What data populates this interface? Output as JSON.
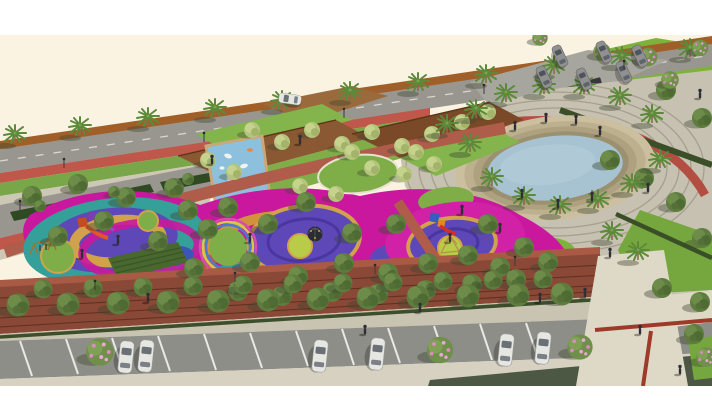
{
  "meta": {
    "kind": "3D architectural rendering",
    "subject": "Aerial bird's-eye visualization of a public park and playground master plan",
    "canvas": {
      "width": 712,
      "height": 416
    },
    "margins": {
      "top_white_band_px": 35,
      "bottom_white_band_px": 30
    }
  },
  "palette": {
    "margin": "#FFFFFF",
    "sky": "#FAF3E2",
    "road": "#98968E",
    "road_wall": "#A05F28",
    "bike_red": "#BF574A",
    "verge_green": "#79A648",
    "sidewalk": "#CDC7B6",
    "parking_lot": "#A7A69E",
    "plaza": "#C6C1B1",
    "plaza_arc": "#A79F8C",
    "walkway": "#DED8C6",
    "track_red": "#B2493C",
    "inlay_red": "#9E3A2A",
    "street": "#8E8E88",
    "curb": "#C9C3B2",
    "terrace_brick": "#8A4836",
    "terrace_walk": "#A85A44",
    "brick_path": "#B05C4A",
    "lawn": "#7FAE48",
    "lawn_bright": "#7FB23C",
    "hedge": "#2F4A22",
    "hedge_shadow": "#4C5844",
    "water": "#A7C2D1",
    "pond_step1": "#CBBF9F",
    "pond_step2": "#BCB08F",
    "pond_step3": "#ADA180",
    "pond_step4": "#9B9070",
    "deck_light": "#9A6A3C",
    "deck": "#8A5832",
    "deck_dark": "#7A4A28",
    "mural_blue": "#8CC0DC",
    "magenta": "#C9189D",
    "pink_bright": "#E455BE",
    "purple": "#5E48B8",
    "purple_deep": "#4A36A0",
    "orange_ring": "#D2A14C",
    "orange_band": "#D2923C",
    "teal": "#35A09A",
    "blue_patch": "#3D55B4",
    "lawn_circle": "#B9CC4A",
    "shrub_bed": "#49682F",
    "tree_olive": "#5D7C3E",
    "tree_light": "#B5C47C",
    "palm_green": "#5C8A3A",
    "blossom_pink": "#D98CC3",
    "car_white": "#E6E6E2",
    "car_gray": "#909090",
    "figure_dark": "#2E2E34"
  },
  "scene": {
    "areas": [
      {
        "name": "top-road",
        "description": "Palm-lined avenue running diagonally along the top edge behind an orange-brown hedge wall"
      },
      {
        "name": "parking-lot-top-right",
        "description": "Small parking lot with six gray cars, blossoming trees and two dark ramp entries"
      },
      {
        "name": "lawn-slope-top-right",
        "description": "Bright green sloped lawn panel at top right corner"
      },
      {
        "name": "terraced-decks",
        "description": "Brown timber terraced decks and ramps interleaved with lawn wedges and light-green trees"
      },
      {
        "name": "koi-mural",
        "description": "Sloped light-blue mosaic triangle with white koi-fish pattern set into the decks"
      },
      {
        "name": "pond-plaza",
        "description": "Circular pond with light blue water, concentric tan step rings, palm ring and gray plaza with arc paving lines"
      },
      {
        "name": "playground",
        "description": "Organic playground field of magenta, purple, orange, teal and blue rubber surfacing with lawn circles, slides, swings, climbing dome and rope pyramid"
      },
      {
        "name": "brick-terraces",
        "description": "Red-brick terraced edge with double staggered row of round clipped trees"
      },
      {
        "name": "street-bottom",
        "description": "Parking street with white bay lines, six white parked cars and pink blossoming trees"
      },
      {
        "name": "walkway-bottom-right",
        "description": "Wide beige pedestrian walkway crossing the street with red inlay strips"
      }
    ],
    "object_counts": {
      "street_parked_cars": 6,
      "parking_lot_cars": 6,
      "road_van": 1,
      "pond": 1,
      "playground_pods": 3,
      "palm_trees_approx": 26,
      "people_figures_approx": 25
    }
  }
}
